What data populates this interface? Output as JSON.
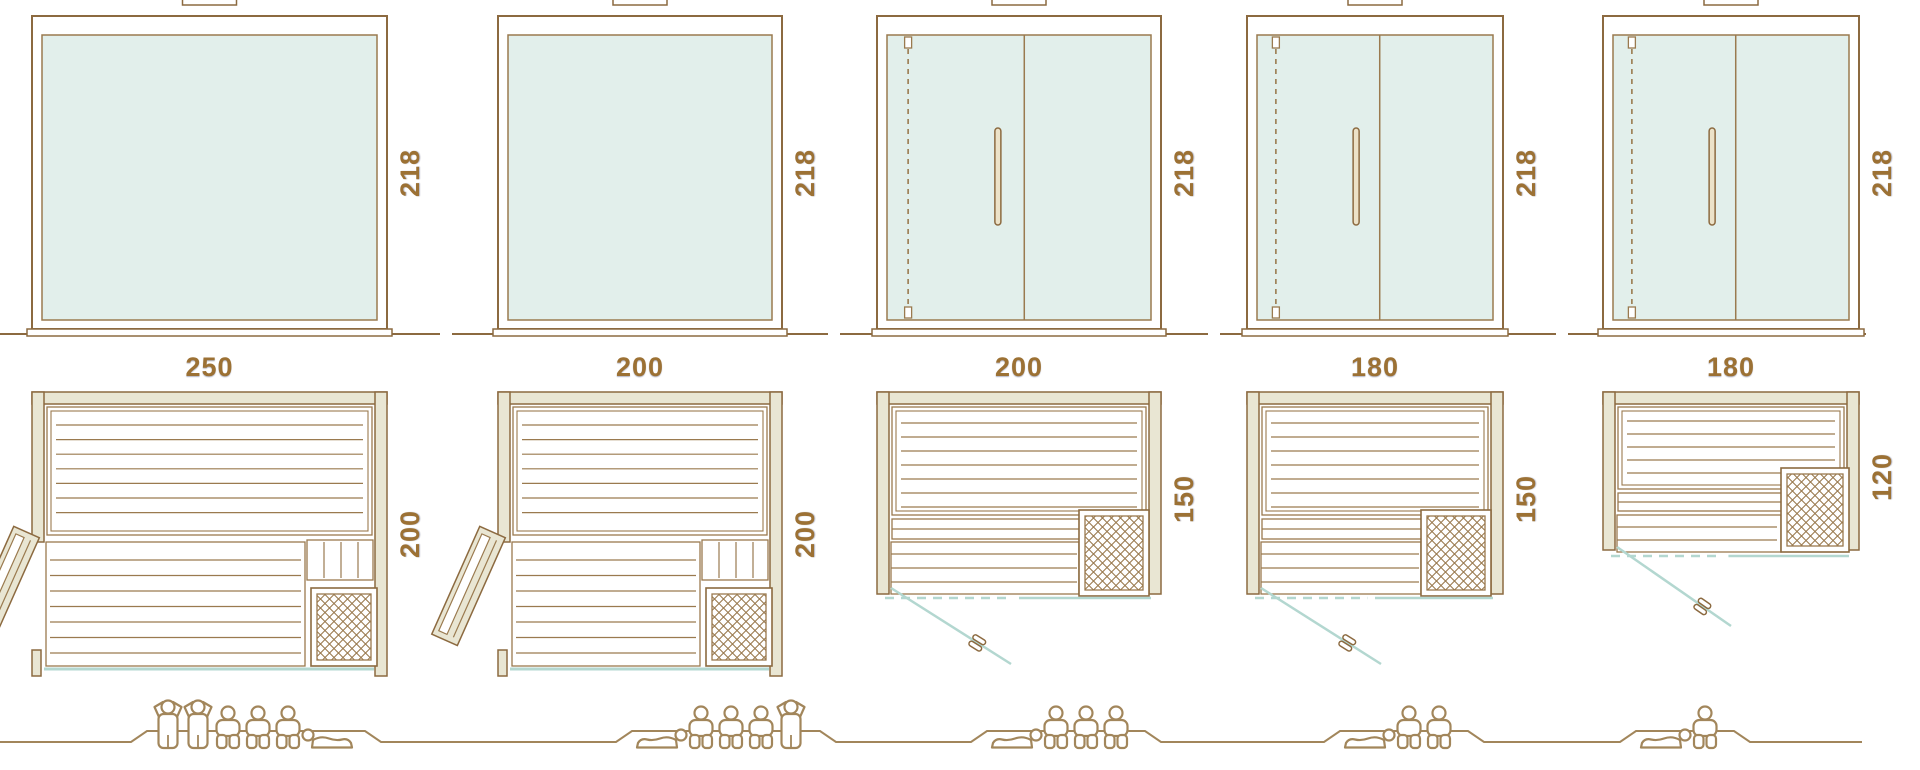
{
  "title": "Sauna model size comparison diagram",
  "palette": {
    "outline": "#8c6a40",
    "line": "#9a7a4f",
    "wall_fill": "#e9e6d3",
    "glass_fill": "#e2efeb",
    "teal_line": "#b3d7d0",
    "label_color": "#9c7134",
    "people_color": "#a2865b",
    "handle_fill": "#ece2c8",
    "background": "#ffffff"
  },
  "saunas": [
    {
      "id": "sauna-1",
      "width_label": "250",
      "depth_label": "200",
      "height_label": "218",
      "width_cm": 250,
      "depth_cm": 200,
      "height_cm": 218,
      "front": "fixed glass front",
      "elevation_door": false,
      "plan_style": "A",
      "plan_door": "hinged wood door open at left side",
      "heater": "lattice heater bottom-right",
      "capacity": {
        "standing": 2,
        "sitting": 3,
        "lying": 1,
        "figures": [
          "standing",
          "standing",
          "sitting",
          "sitting",
          "sitting",
          "lying_head_left"
        ]
      }
    },
    {
      "id": "sauna-2",
      "width_label": "200",
      "depth_label": "200",
      "height_label": "218",
      "width_cm": 200,
      "depth_cm": 200,
      "height_cm": 218,
      "front": "fixed glass front",
      "elevation_door": false,
      "plan_style": "A",
      "plan_door": "hinged wood door open at left side",
      "heater": "lattice heater bottom-right",
      "capacity": {
        "standing": 1,
        "sitting": 3,
        "lying": 1,
        "figures": [
          "lying_head_right",
          "sitting",
          "sitting",
          "sitting",
          "standing"
        ]
      }
    },
    {
      "id": "sauna-3",
      "width_label": "200",
      "depth_label": "150",
      "height_label": "218",
      "width_cm": 200,
      "depth_cm": 150,
      "height_cm": 218,
      "front": "glass door with fixed glass panel",
      "elevation_door": true,
      "plan_style": "B",
      "plan_door": "glass door shown open in front",
      "heater": "lattice heater bottom-right",
      "capacity": {
        "standing": 0,
        "sitting": 3,
        "lying": 1,
        "figures": [
          "lying_head_right",
          "sitting",
          "sitting",
          "sitting"
        ]
      }
    },
    {
      "id": "sauna-4",
      "width_label": "180",
      "depth_label": "150",
      "height_label": "218",
      "width_cm": 180,
      "depth_cm": 150,
      "height_cm": 218,
      "front": "glass door with fixed glass panel",
      "elevation_door": true,
      "plan_style": "B",
      "plan_door": "glass door shown open in front",
      "heater": "lattice heater bottom-right",
      "capacity": {
        "standing": 0,
        "sitting": 2,
        "lying": 1,
        "figures": [
          "lying_head_right",
          "sitting",
          "sitting"
        ]
      }
    },
    {
      "id": "sauna-5",
      "width_label": "180",
      "depth_label": "120",
      "height_label": "218",
      "width_cm": 180,
      "depth_cm": 120,
      "height_cm": 218,
      "front": "glass door with fixed glass panel",
      "elevation_door": true,
      "plan_style": "C",
      "plan_door": "glass door shown open in front",
      "heater": "lattice heater mid-right",
      "capacity": {
        "standing": 0,
        "sitting": 1,
        "lying": 1,
        "figures": [
          "lying_head_right",
          "sitting"
        ]
      }
    }
  ]
}
